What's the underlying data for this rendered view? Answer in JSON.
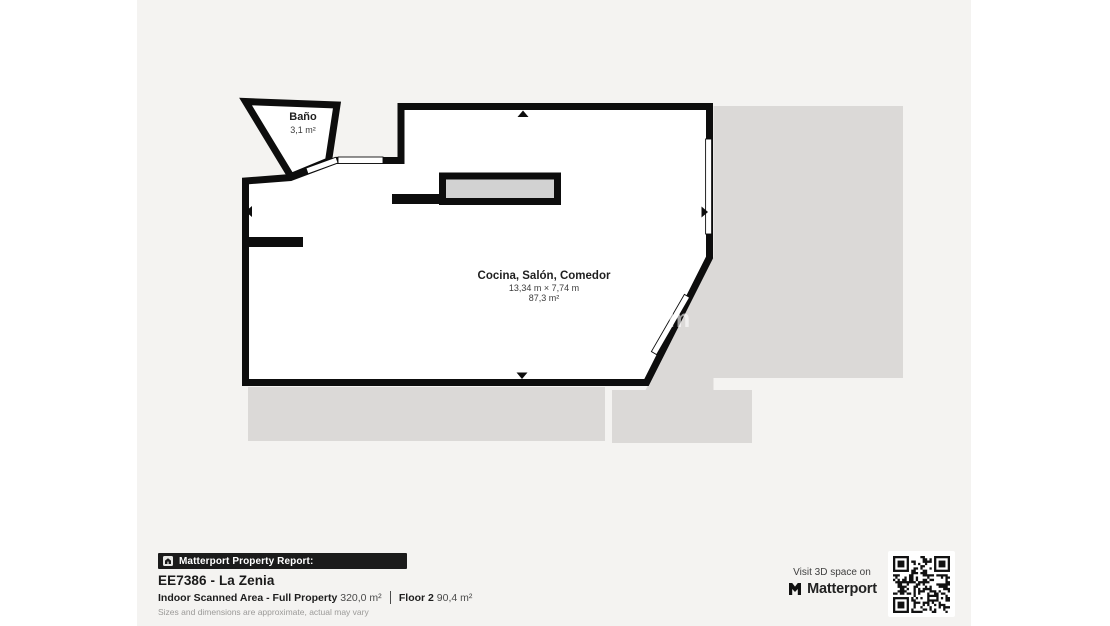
{
  "floor_plan": {
    "bathroom": {
      "name": "Baño",
      "area": "3,1 m²"
    },
    "main_room": {
      "name": "Cocina, Salón, Comedor",
      "dimensions": "13,34 m × 7,74 m",
      "area": "87,3 m²"
    },
    "watermark": "m"
  },
  "footer": {
    "report_bar": "Matterport Property Report:",
    "property_title": "EE7386 - La Zenia",
    "scanned_area_label": "Indoor Scanned Area - Full Property",
    "scanned_area_value": "320,0 m²",
    "floor_label": "Floor 2",
    "floor_value": "90,4 m²",
    "disclaimer": "Sizes and dimensions are approximate, actual may vary"
  },
  "promo": {
    "visit_text": "Visit 3D space on",
    "brand": "Matterport"
  },
  "colors": {
    "paper": "#f4f3f1",
    "wall": "#0d0d0d",
    "unscanned_gray": "#dbd9d7",
    "counter_fill": "#d2d2d2",
    "bar_bg": "#1b1b1b",
    "title_text": "#1a1a1a",
    "muted_text": "#9b9a98"
  }
}
